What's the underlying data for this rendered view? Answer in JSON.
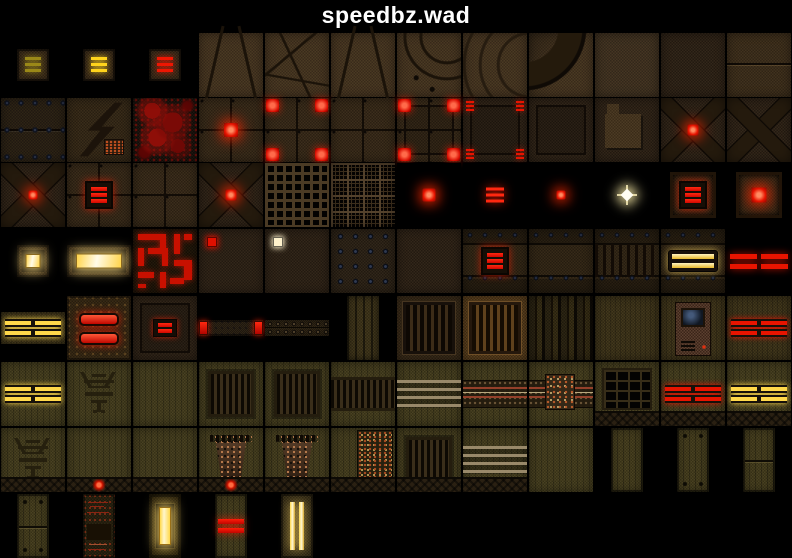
{
  "window": {
    "title": "speedbz.wad"
  },
  "palette": {
    "background": "#000000",
    "title_color": "#ffffff",
    "accent_red": "#e81400",
    "accent_yellow": "#ffd84a",
    "accent_dim_yellow": "#9a8818",
    "accent_pale_white": "#fff2cc",
    "base_brown": "#3a2c18",
    "base_olive": "#454020"
  },
  "grid": {
    "col_width": 66,
    "rows": [
      {
        "y": 32,
        "h": 65,
        "cells": [
          {
            "col": 0,
            "name": "tex-switch-bars-dim",
            "kind": "bars3",
            "w": 32,
            "h": 32,
            "vars": {
              "--a": "#9a8818"
            }
          },
          {
            "col": 1,
            "name": "tex-switch-bars-yellow",
            "kind": "bars3",
            "w": 32,
            "h": 32,
            "vars": {
              "--a": "#ffd41c"
            }
          },
          {
            "col": 2,
            "name": "tex-switch-bars-red",
            "kind": "bars3",
            "w": 32,
            "h": 32,
            "vars": {
              "--a": "#ee1602"
            }
          },
          {
            "col": 3,
            "name": "tex-rock-keystone-small",
            "kind": "rock-keystone",
            "w": 64,
            "h": 64
          },
          {
            "col": 4,
            "name": "tex-rock-cobbles",
            "kind": "rock-poly",
            "w": 64,
            "h": 64
          },
          {
            "col": 5,
            "name": "tex-rock-keystone-large",
            "kind": "rock-keystone",
            "w": 64,
            "h": 64
          },
          {
            "col": 6,
            "name": "tex-rock-arch-riveted",
            "kind": "rock-arch",
            "w": 64,
            "h": 64
          },
          {
            "col": 7,
            "name": "tex-rock-arch-curves",
            "kind": "rock-curves",
            "w": 64,
            "h": 64
          },
          {
            "col": 8,
            "name": "tex-rock-arch-band",
            "kind": "rock-archband",
            "w": 64,
            "h": 64
          },
          {
            "col": 9,
            "name": "tex-metal-noise-light",
            "kind": "noise-l",
            "w": 64,
            "h": 64
          },
          {
            "col": 10,
            "name": "tex-metal-noise-dark",
            "kind": "noise-d",
            "w": 64,
            "h": 64
          },
          {
            "col": 11,
            "name": "tex-metal-noise-split",
            "kind": "noise-split",
            "w": 64,
            "h": 64
          }
        ]
      },
      {
        "y": 97,
        "h": 65,
        "cells": [
          {
            "col": 0,
            "name": "tex-riveted-panels",
            "kind": "riv2",
            "w": 64,
            "h": 64
          },
          {
            "col": 1,
            "name": "tex-metal-zigzag-bolt",
            "kind": "zig",
            "w": 64,
            "h": 64
          },
          {
            "col": 2,
            "name": "tex-blood-splatter",
            "kind": "blood",
            "w": 64,
            "h": 64
          },
          {
            "col": 3,
            "name": "tex-floor-red-light-center",
            "kind": "quad lightc",
            "w": 64,
            "h": 64,
            "vars": {
              "--sz": "14px"
            }
          },
          {
            "col": 4,
            "name": "tex-floor-red-corners",
            "kind": "quad corners4",
            "w": 64,
            "h": 64
          },
          {
            "col": 5,
            "name": "tex-floor-quad-plain",
            "kind": "quad",
            "w": 64,
            "h": 64
          },
          {
            "col": 6,
            "name": "tex-floor-corners-framed",
            "kind": "quad inframe corners4",
            "w": 64,
            "h": 64
          },
          {
            "col": 7,
            "name": "tex-panel-corner-bars",
            "kind": "noise-d inframe cornerbars",
            "w": 64,
            "h": 64
          },
          {
            "col": 8,
            "name": "tex-panel-framed-plain",
            "kind": "noise-d inframe",
            "w": 64,
            "h": 64
          },
          {
            "col": 9,
            "name": "tex-panel-patch",
            "kind": "noise-d patch",
            "w": 64,
            "h": 64
          },
          {
            "col": 10,
            "name": "tex-cross-red-light",
            "kind": "xbars lightc",
            "w": 64,
            "h": 64,
            "vars": {
              "--sz": "11px"
            }
          },
          {
            "col": 11,
            "name": "tex-cross-plain",
            "kind": "xbars",
            "w": 64,
            "h": 64
          }
        ]
      },
      {
        "y": 162,
        "h": 66,
        "cells": [
          {
            "col": 0,
            "name": "tex-cross-red-small",
            "kind": "xbars lightc",
            "w": 64,
            "h": 64,
            "vars": {
              "--sz": "9px"
            }
          },
          {
            "col": 1,
            "name": "tex-floor-red-bars-box",
            "kind": "quad redbox3",
            "w": 64,
            "h": 64
          },
          {
            "col": 2,
            "name": "tex-floor-quad-plain-2",
            "kind": "quad",
            "w": 64,
            "h": 64
          },
          {
            "col": 3,
            "name": "tex-cross-red-light-2",
            "kind": "xbars lightc",
            "w": 64,
            "h": 64,
            "vars": {
              "--sz": "11px"
            }
          },
          {
            "col": 4,
            "name": "tex-grate-coarse",
            "kind": "grate-c",
            "w": 64,
            "h": 64
          },
          {
            "col": 5,
            "name": "tex-grate-fine",
            "kind": "grate-f",
            "w": 64,
            "h": 64
          },
          {
            "col": 6,
            "name": "tex-red-light-square",
            "kind": "black lightc",
            "w": 64,
            "h": 64,
            "vars": {
              "--sz": "13px"
            }
          },
          {
            "col": 7,
            "name": "tex-red-light-bars",
            "kind": "black glowbars",
            "w": 64,
            "h": 64
          },
          {
            "col": 8,
            "name": "tex-red-light-small",
            "kind": "black lightc",
            "w": 64,
            "h": 64,
            "vars": {
              "--sz": "9px"
            }
          },
          {
            "col": 9,
            "name": "tex-star-light",
            "kind": "black star",
            "w": 64,
            "h": 64
          },
          {
            "col": 10,
            "name": "tex-box-red-bars",
            "kind": "black boxframe redbox3",
            "w": 64,
            "h": 64
          },
          {
            "col": 11,
            "name": "tex-box-red-light",
            "kind": "black boxframe lightc",
            "w": 64,
            "h": 64,
            "vars": {
              "--sz": "15px"
            }
          }
        ]
      },
      {
        "y": 228,
        "h": 66,
        "cells": [
          {
            "col": 0,
            "name": "tex-yellow-lightbox-small",
            "kind": "lightbox",
            "w": 32,
            "h": 32,
            "vars": {
              "--lw": "13px",
              "--lh": "12px"
            }
          },
          {
            "col": 1,
            "name": "tex-yellow-lightbox-wide",
            "kind": "lightbox",
            "w": 64,
            "h": 32,
            "vars": {
              "--lw": "44px",
              "--lh": "13px"
            }
          },
          {
            "col": 2,
            "name": "tex-red-circuit-pattern",
            "kind": "circuit",
            "w": 64,
            "h": 64
          },
          {
            "col": 3,
            "name": "tex-panel-red-marker",
            "kind": "noise-d dottl",
            "w": 64,
            "h": 64,
            "vars": {
              "--a": "#e01000"
            }
          },
          {
            "col": 4,
            "name": "tex-panel-white-marker",
            "kind": "noise-d dottl",
            "w": 64,
            "h": 64,
            "vars": {
              "--a": "#fff2cc"
            }
          },
          {
            "col": 5,
            "name": "tex-riveted-plate",
            "kind": "rivetgrid",
            "w": 64,
            "h": 64
          },
          {
            "col": 6,
            "name": "tex-metal-plain",
            "kind": "noise-d",
            "w": 64,
            "h": 64
          },
          {
            "col": 7,
            "name": "tex-banded-red-bars",
            "kind": "bands redbox3",
            "w": 64,
            "h": 64
          },
          {
            "col": 8,
            "name": "tex-banded-plain",
            "kind": "bands",
            "w": 64,
            "h": 64
          },
          {
            "col": 9,
            "name": "tex-banded-slats",
            "kind": "bands slatsmid",
            "w": 64,
            "h": 64
          },
          {
            "col": 10,
            "name": "tex-banded-yellow-bars",
            "kind": "bands ybars2",
            "w": 64,
            "h": 64
          },
          {
            "col": 11,
            "name": "tex-red-bars-quad-wide",
            "kind": "black red4w",
            "w": 64,
            "h": 32
          }
        ]
      },
      {
        "y": 294,
        "h": 67,
        "cells": [
          {
            "col": 0,
            "name": "tex-yellow-bars-quad",
            "kind": "olive olive4",
            "w": 64,
            "h": 32,
            "vars": {
              "--a": "#ffd84a"
            }
          },
          {
            "col": 1,
            "name": "tex-ornate-red-capsules",
            "kind": "ornate",
            "w": 64,
            "h": 64
          },
          {
            "col": 2,
            "name": "tex-framed-red-bars",
            "kind": "noise-d inframe bars2sm",
            "w": 64,
            "h": 64
          },
          {
            "col": 3,
            "name": "tex-beam-red-ends",
            "kind": "beamends",
            "w": 64,
            "h": 16
          },
          {
            "col": 4,
            "name": "tex-beam-riveted",
            "kind": "beamriv",
            "w": 64,
            "h": 16
          },
          {
            "col": 5,
            "name": "tex-slatted-column",
            "kind": "slatsv",
            "w": 32,
            "h": 64
          },
          {
            "col": 6,
            "name": "tex-grille-framed",
            "kind": "grille",
            "w": 64,
            "h": 64
          },
          {
            "col": 7,
            "name": "tex-grille-framed-bright",
            "kind": "grille bright",
            "w": 64,
            "h": 64
          },
          {
            "col": 8,
            "name": "tex-dark-planks",
            "kind": "planks",
            "w": 64,
            "h": 64
          },
          {
            "col": 9,
            "name": "tex-olive-plain",
            "kind": "olive",
            "w": 64,
            "h": 64
          },
          {
            "col": 10,
            "name": "tex-tech-console",
            "kind": "olive console",
            "w": 64,
            "h": 64
          },
          {
            "col": 11,
            "name": "tex-red-bars-quad-olive",
            "kind": "olive olive4",
            "w": 64,
            "h": 64,
            "vars": {
              "--a": "#e81400"
            }
          }
        ]
      },
      {
        "y": 361,
        "h": 66,
        "cells": [
          {
            "col": 0,
            "name": "tex-wood-yellow-bars",
            "kind": "wood olive4",
            "w": 64,
            "h": 64,
            "vars": {
              "--a": "#ffd84a"
            }
          },
          {
            "col": 1,
            "name": "tex-wood-emblem",
            "kind": "wood emblem",
            "w": 64,
            "h": 64
          },
          {
            "col": 2,
            "name": "tex-wood-plain",
            "kind": "wood",
            "w": 64,
            "h": 64
          },
          {
            "col": 3,
            "name": "tex-wood-vent",
            "kind": "wood vent",
            "w": 64,
            "h": 64
          },
          {
            "col": 4,
            "name": "tex-wood-vent-2",
            "kind": "wood vent",
            "w": 64,
            "h": 64
          },
          {
            "col": 5,
            "name": "tex-wood-vent-wide",
            "kind": "wood ventwide",
            "w": 64,
            "h": 64
          },
          {
            "col": 6,
            "name": "tex-wood-stripes",
            "kind": "wood stripes4",
            "w": 64,
            "h": 64
          },
          {
            "col": 7,
            "name": "tex-wood-tech-strip",
            "kind": "wood tech",
            "w": 64,
            "h": 64
          },
          {
            "col": 8,
            "name": "tex-wood-tech-machinery",
            "kind": "wood tech tech2",
            "w": 64,
            "h": 64
          },
          {
            "col": 9,
            "name": "tex-wood-window-base",
            "kind": "wood window base",
            "w": 64,
            "h": 64
          },
          {
            "col": 10,
            "name": "tex-wood-red-bars-base",
            "kind": "wood olive4 base",
            "w": 64,
            "h": 64,
            "vars": {
              "--a": "#e81400"
            }
          },
          {
            "col": 11,
            "name": "tex-wood-yellow-bars-base",
            "kind": "wood olive4 base",
            "w": 64,
            "h": 64,
            "vars": {
              "--a": "#ffd84a"
            }
          }
        ]
      },
      {
        "y": 427,
        "h": 66,
        "cells": [
          {
            "col": 0,
            "name": "tex-wall-emblem",
            "kind": "wood emblem base",
            "w": 64,
            "h": 64
          },
          {
            "col": 1,
            "name": "tex-wall-red-light",
            "kind": "wood base baselight",
            "w": 64,
            "h": 64
          },
          {
            "col": 2,
            "name": "tex-wall-plain-base",
            "kind": "wood base",
            "w": 64,
            "h": 64
          },
          {
            "col": 3,
            "name": "tex-wall-machine-light",
            "kind": "wood machine base baselight",
            "w": 64,
            "h": 64
          },
          {
            "col": 4,
            "name": "tex-wall-machine",
            "kind": "wood machine base",
            "w": 64,
            "h": 64
          },
          {
            "col": 5,
            "name": "tex-wall-circuitry",
            "kind": "wood circuitwall base",
            "w": 64,
            "h": 64
          },
          {
            "col": 6,
            "name": "tex-wall-vent",
            "kind": "wood vent base",
            "w": 64,
            "h": 64
          },
          {
            "col": 7,
            "name": "tex-wall-stripes",
            "kind": "wood stripes4 base",
            "w": 64,
            "h": 64
          },
          {
            "col": 8,
            "name": "tex-wall-plain",
            "kind": "wood",
            "w": 64,
            "h": 64
          },
          {
            "col": 9,
            "name": "tex-door-plain",
            "kind": "door",
            "w": 32,
            "h": 64
          },
          {
            "col": 10,
            "name": "tex-door-bolted",
            "kind": "door bolts",
            "w": 32,
            "h": 64
          },
          {
            "col": 11,
            "name": "tex-door-seam",
            "kind": "door seam",
            "w": 32,
            "h": 64
          }
        ]
      },
      {
        "y": 493,
        "h": 65,
        "cells": [
          {
            "col": 0,
            "name": "tex-door-bolted-seam",
            "kind": "door bolts seam",
            "w": 32,
            "h": 64
          },
          {
            "col": 1,
            "name": "tex-door-circuitry",
            "kind": "doorc",
            "w": 32,
            "h": 64
          },
          {
            "col": 2,
            "name": "tex-door-yellow-slot",
            "kind": "doorslot",
            "w": 32,
            "h": 64
          },
          {
            "col": 3,
            "name": "tex-door-red-bars",
            "kind": "door rbars2",
            "w": 32,
            "h": 64
          },
          {
            "col": 4,
            "name": "tex-door-yellow-columns",
            "kind": "doorv ybarsv",
            "w": 32,
            "h": 64
          }
        ]
      }
    ]
  }
}
